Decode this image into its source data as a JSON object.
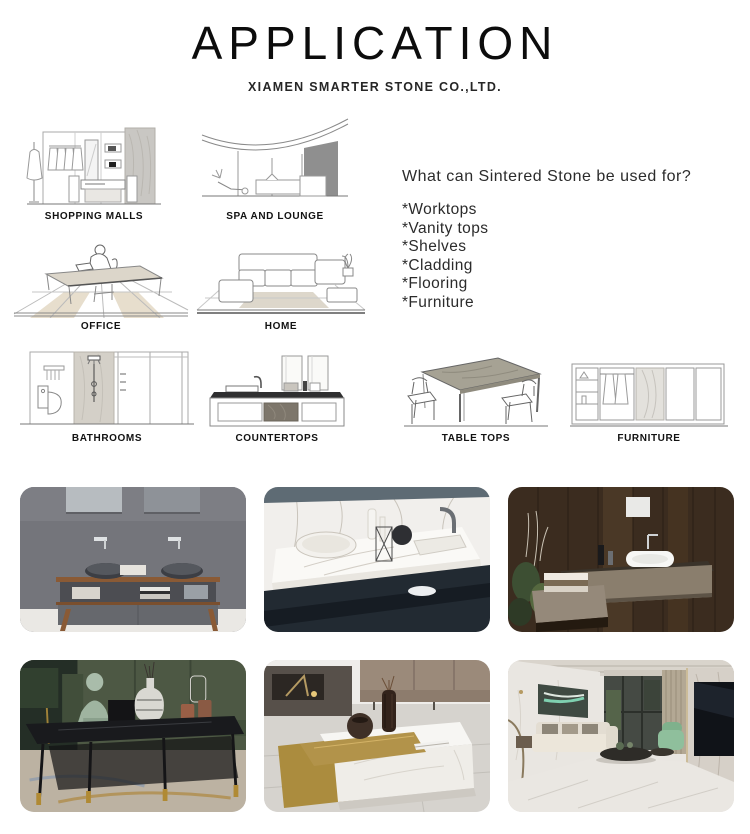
{
  "header": {
    "title": "APPLICATION",
    "subtitle": "XIAMEN SMARTER STONE CO.,LTD."
  },
  "intro": {
    "question": "What can Sintered Stone be used for?",
    "uses": [
      "*Worktops",
      "*Vanity tops",
      "*Shelves",
      "*Cladding",
      "*Flooring",
      "*Furniture"
    ]
  },
  "applications": [
    {
      "label": "SHOPPING MALLS"
    },
    {
      "label": "SPA AND LOUNGE"
    },
    {
      "label": "OFFICE"
    },
    {
      "label": "HOME"
    },
    {
      "label": "BATHROOMS"
    },
    {
      "label": "COUNTERTOPS"
    },
    {
      "label": "TABLE TOPS"
    },
    {
      "label": "FURNITURE"
    }
  ],
  "gallery": {
    "photos": [
      {
        "name": "double-basin-grey-stone-vanity"
      },
      {
        "name": "white-marble-washbasin-countertop"
      },
      {
        "name": "floating-stone-vanity-dark-wood-wall"
      },
      {
        "name": "black-sintered-stone-coffee-table"
      },
      {
        "name": "white-marble-gold-coffee-table"
      },
      {
        "name": "marble-floor-living-room"
      }
    ]
  },
  "colors": {
    "ink": "#0c0c0c",
    "stone_grey": "#c9c7c3",
    "gold_accent": "#b08a34"
  }
}
